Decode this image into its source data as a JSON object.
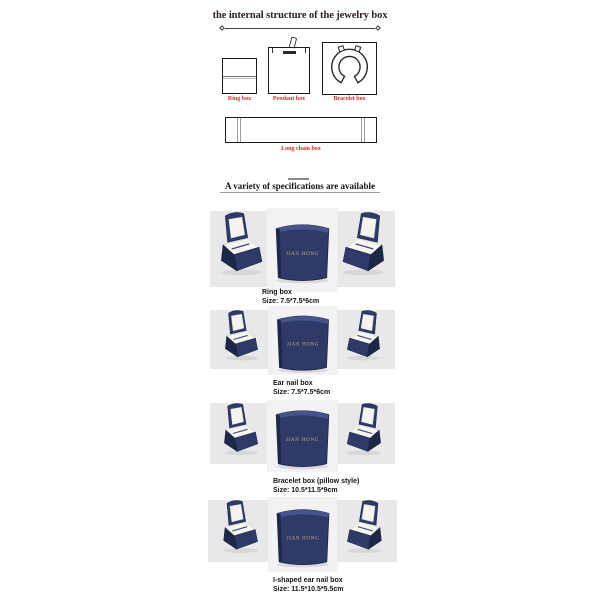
{
  "title": "the internal structure of the jewelry box",
  "structure_diagrams": {
    "ring_label": "Ring box",
    "pendant_label": "Pendant box",
    "bracelet_label": "Bracelet box",
    "long_chain_label": "Long chain box"
  },
  "specs_heading": "A variety of specifications are available",
  "brand": "JIAN HONG",
  "products": [
    {
      "name": "Ring box",
      "size": "Size: 7.5*7.5*6cm"
    },
    {
      "name": "Ear nail box",
      "size": "Size: 7.5*7.5*6cm"
    },
    {
      "name": "Bracelet box (pillow style)",
      "size": "Size: 10.5*11.5*9cm"
    },
    {
      "name": "I-shaped ear nail box",
      "size": "Size: 11.5*10.5*5.5cm"
    }
  ],
  "colors": {
    "box_navy": "#2e3a68",
    "box_navy_dark": "#1d2748",
    "interior_white": "#f4f3ee",
    "label_red": "#e02222",
    "brand_gold": "#c9a86b",
    "photo_bg": "#e8e8ea",
    "photo_bg_middle": "#f2f2f4"
  }
}
